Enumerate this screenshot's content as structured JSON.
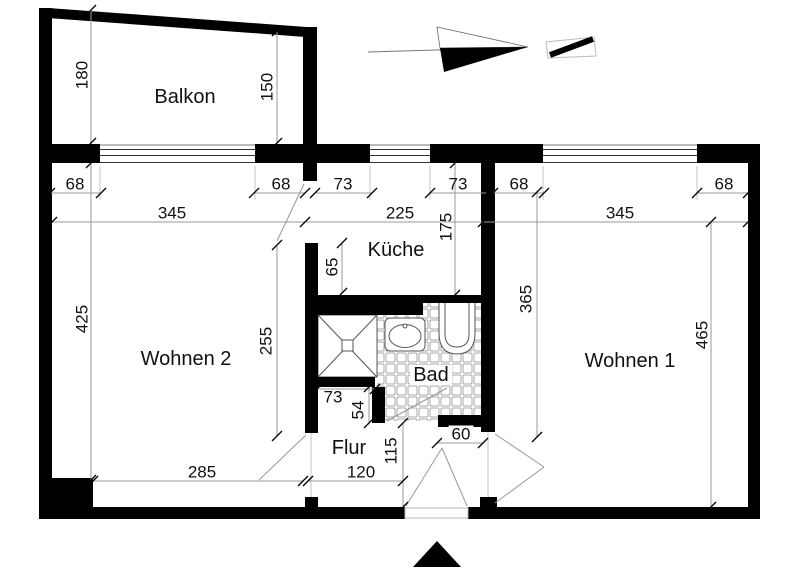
{
  "meta": {
    "type": "floor-plan",
    "language": "de"
  },
  "colors": {
    "background": "#ffffff",
    "wall": "#000000",
    "dim_line": "#9a9a9a",
    "text": "#111111"
  },
  "rooms": {
    "balkon": "Balkon",
    "wohnen2": "Wohnen 2",
    "wohnen1": "Wohnen 1",
    "kueche": "Küche",
    "bad": "Bad",
    "flur": "Flur"
  },
  "dimensions": {
    "balkon_depth_left": "180",
    "balkon_depth_right": "150",
    "w2_pier_left": "68",
    "w2_window": "345",
    "w2_pier_right": "68",
    "k_pier_left": "73",
    "k_window": "225",
    "k_pier_right": "73",
    "w1_pier_left": "68",
    "w1_window": "345",
    "w1_pier_right": "68",
    "w2_height": "425",
    "w2_inner_height": "255",
    "w2_bottom_width": "285",
    "k_wall_nib": "65",
    "k_depth": "175",
    "w1_height_left": "365",
    "w1_height_right": "465",
    "shower_wall_width": "73",
    "bad_wall_nib": "54",
    "bad_door_width": "60",
    "flur_depth": "115",
    "flur_entry_width": "120"
  },
  "icons": {
    "north_arrow": "north-arrow",
    "scale_mark": "scale-mark",
    "entrance_marker": "entrance-triangle"
  },
  "fixtures": {
    "shower": "shower-tray",
    "sink": "washbasin",
    "toilet": "toilet",
    "tiles": "tiled-floor"
  }
}
